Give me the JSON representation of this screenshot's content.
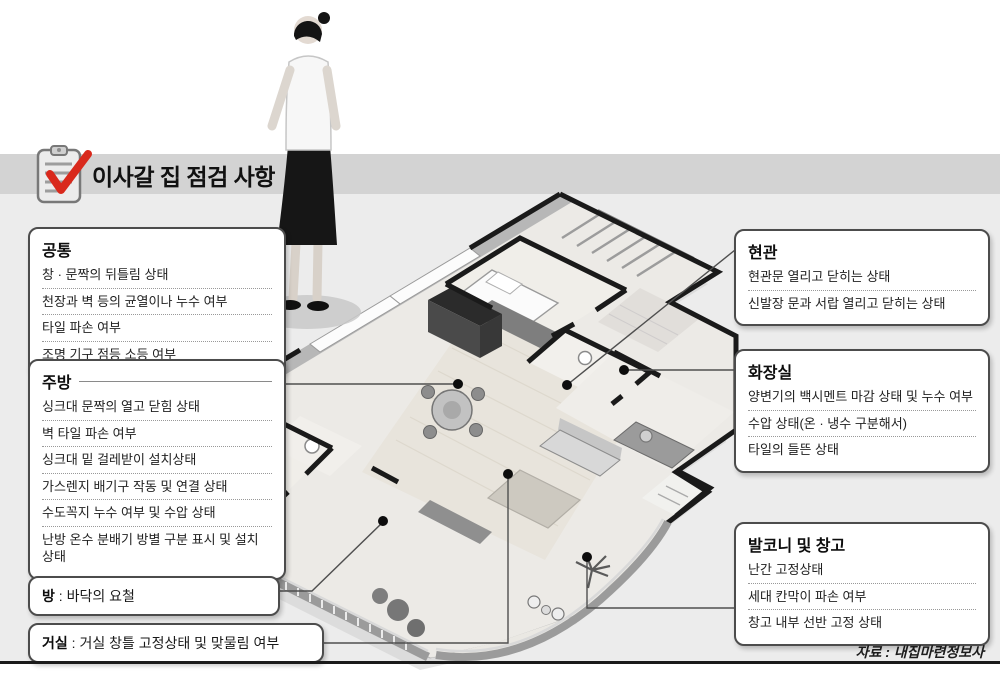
{
  "header": {
    "title": "이사갈 집 점검 사항",
    "icon": "clipboard-check-icon"
  },
  "source_label": "자료 : 내집마련정보사",
  "boxes": {
    "common": {
      "title": "공통",
      "items": [
        "창 · 문짝의 뒤틀림 상태",
        "천장과 벽 등의 균열이나 누수 여부",
        "타일 파손 여부",
        "조명 기구 점등 소등 여부"
      ]
    },
    "kitchen": {
      "title": "주방",
      "items": [
        "싱크대 문짝의 열고 닫힘 상태",
        "벽 타일 파손 여부",
        "싱크대 밑 걸레받이 설치상태",
        "가스렌지 배기구 작동 및 연결 상태",
        "수도꼭지 누수 여부 및 수압 상태",
        "난방 온수 분배기 방별 구분 표시 및 설치 상태"
      ]
    },
    "room": {
      "title": "방",
      "separator": " : ",
      "text": "바닥의 요철"
    },
    "living": {
      "title": "거실",
      "separator": " : ",
      "text": "거실 창틀 고정상태 및 맞물림 여부"
    },
    "entrance": {
      "title": "현관",
      "items": [
        "현관문 열리고 닫히는 상태",
        "신발장 문과 서랍 열리고 닫히는 상태"
      ]
    },
    "bathroom": {
      "title": "화장실",
      "items": [
        "양변기의 백시멘트 마감 상태 및 누수 여부",
        "수압 상태(온 · 냉수 구분해서)",
        "타일의 들뜬 상태"
      ]
    },
    "balcony": {
      "title": "발코니 및 창고",
      "items": [
        "난간 고정상태",
        "세대 칸막이 파손 여부",
        "창고 내부 선반 고정 상태"
      ]
    }
  },
  "colors": {
    "accent_red": "#d9291c",
    "header_band": "#d3d3d3",
    "page_background": "#ececec",
    "box_border": "#4c4c4c",
    "bottom_rule": "#1a1a1a"
  }
}
